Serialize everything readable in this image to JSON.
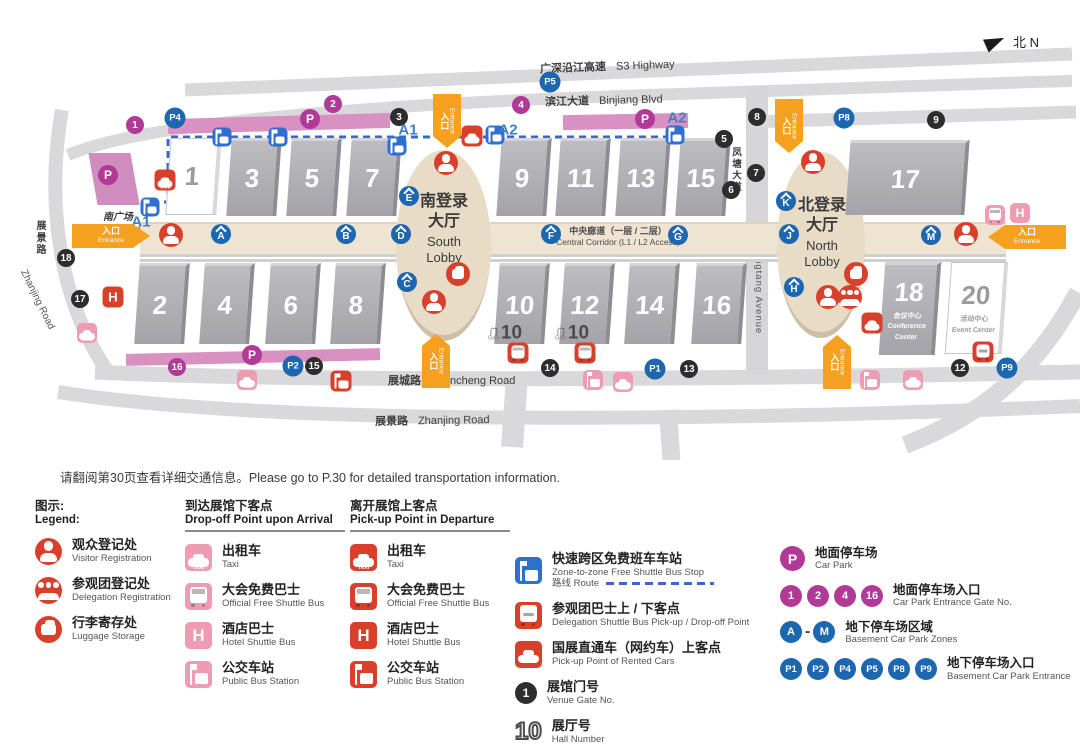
{
  "compass": {
    "label": "北 N"
  },
  "roads": {
    "s3": {
      "zh": "广深沿江高速",
      "en": "S3 Highway"
    },
    "binjiang": {
      "zh": "滨江大道",
      "en": "Binjiang Blvd"
    },
    "fengtang": {
      "zh": "凤塘大道",
      "en": "Fengtang Avenue"
    },
    "zhancheng": {
      "zh": "展城路",
      "en": "Zhancheng Road"
    },
    "zhanjing_bottom": {
      "zh": "展景路",
      "en": "Zhanjing Road"
    },
    "zhanjing_left": {
      "zh": "展景路",
      "en": "Zhanjing Road"
    }
  },
  "plaza": {
    "zh": "南广场",
    "en": "South Plaza"
  },
  "lobbies": {
    "south": {
      "zh1": "南登录",
      "zh2": "大厅",
      "en1": "South",
      "en2": "Lobby"
    },
    "north": {
      "zh1": "北登录",
      "zh2": "大厅",
      "en1": "North",
      "en2": "Lobby"
    }
  },
  "corridor": {
    "zh": "中央廊道（一层 / 二层）",
    "en": "Central Corridor (L1 / L2 Access)"
  },
  "entrance_label": {
    "zh": "入口",
    "en": "Entrance"
  },
  "halls": [
    {
      "x": 168,
      "y": 138,
      "w": 46,
      "h": 75,
      "n": "1",
      "white": true
    },
    {
      "x": 229,
      "y": 138,
      "w": 46,
      "h": 75,
      "n": "3"
    },
    {
      "x": 289,
      "y": 138,
      "w": 46,
      "h": 75,
      "n": "5"
    },
    {
      "x": 349,
      "y": 138,
      "w": 46,
      "h": 75,
      "n": "7"
    },
    {
      "x": 499,
      "y": 138,
      "w": 46,
      "h": 75,
      "n": "9"
    },
    {
      "x": 558,
      "y": 138,
      "w": 46,
      "h": 75,
      "n": "11"
    },
    {
      "x": 618,
      "y": 138,
      "w": 46,
      "h": 75,
      "n": "13"
    },
    {
      "x": 678,
      "y": 138,
      "w": 46,
      "h": 75,
      "n": "15"
    },
    {
      "x": 848,
      "y": 140,
      "w": 115,
      "h": 72,
      "n": "17"
    },
    {
      "x": 137,
      "y": 263,
      "w": 46,
      "h": 78,
      "n": "2"
    },
    {
      "x": 202,
      "y": 263,
      "w": 46,
      "h": 78,
      "n": "4"
    },
    {
      "x": 268,
      "y": 263,
      "w": 46,
      "h": 78,
      "n": "6"
    },
    {
      "x": 333,
      "y": 263,
      "w": 46,
      "h": 78,
      "n": "8"
    },
    {
      "x": 497,
      "y": 263,
      "w": 46,
      "h": 78,
      "n": "10"
    },
    {
      "x": 562,
      "y": 263,
      "w": 46,
      "h": 78,
      "n": "12"
    },
    {
      "x": 627,
      "y": 263,
      "w": 46,
      "h": 78,
      "n": "14"
    },
    {
      "x": 694,
      "y": 263,
      "w": 46,
      "h": 78,
      "n": "16"
    },
    {
      "x": 882,
      "y": 262,
      "w": 52,
      "h": 90,
      "n": "18",
      "sub_zh": "会议中心",
      "sub_en": "Conference Center"
    },
    {
      "x": 948,
      "y": 262,
      "w": 52,
      "h": 90,
      "n": "20",
      "white": true,
      "sub_zh": "活动中心",
      "sub_en": "Event Center"
    }
  ],
  "markers": {
    "venue_gates": [
      [
        399,
        117,
        "3"
      ],
      [
        724,
        139,
        "5"
      ],
      [
        731,
        190,
        "6"
      ],
      [
        756,
        173,
        "7"
      ],
      [
        757,
        117,
        "8"
      ],
      [
        936,
        120,
        "9"
      ],
      [
        960,
        368,
        "12"
      ],
      [
        689,
        369,
        "13"
      ],
      [
        550,
        368,
        "14"
      ],
      [
        314,
        366,
        "15"
      ],
      [
        80,
        299,
        "17"
      ],
      [
        66,
        258,
        "18"
      ]
    ],
    "carpark_gates": [
      [
        135,
        125,
        "1"
      ],
      [
        333,
        104,
        "2"
      ],
      [
        521,
        105,
        "4"
      ],
      [
        177,
        367,
        "16"
      ]
    ],
    "carpark_p": [
      [
        108,
        175
      ],
      [
        310,
        119
      ],
      [
        645,
        119
      ],
      [
        252,
        355
      ]
    ],
    "basement_entrances": [
      [
        655,
        369,
        "P1"
      ],
      [
        293,
        366,
        "P2"
      ],
      [
        175,
        118,
        "P4"
      ],
      [
        550,
        82,
        "P5"
      ],
      [
        844,
        118,
        "P8"
      ],
      [
        1007,
        368,
        "P9"
      ]
    ],
    "zones": [
      [
        221,
        234,
        "A"
      ],
      [
        346,
        234,
        "B"
      ],
      [
        407,
        282,
        "C"
      ],
      [
        401,
        234,
        "D"
      ],
      [
        409,
        196,
        "E"
      ],
      [
        551,
        234,
        "F"
      ],
      [
        678,
        235,
        "G"
      ],
      [
        794,
        287,
        "H"
      ],
      [
        789,
        234,
        "J"
      ],
      [
        786,
        201,
        "K"
      ],
      [
        931,
        235,
        "M"
      ]
    ],
    "red": {
      "visitor": [
        [
          171,
          235
        ],
        [
          446,
          163
        ],
        [
          434,
          302
        ],
        [
          813,
          162
        ],
        [
          966,
          234
        ],
        [
          828,
          297
        ]
      ],
      "delegation": [
        [
          850,
          297
        ]
      ],
      "luggage": [
        [
          458,
          274
        ],
        [
          856,
          274
        ]
      ],
      "taxi": [
        [
          165,
          180
        ]
      ],
      "car": [
        [
          472,
          136
        ],
        [
          872,
          323
        ]
      ],
      "bus": [
        [
          518,
          353
        ],
        [
          585,
          353
        ]
      ],
      "hotel": [
        [
          113,
          297
        ]
      ],
      "station": [
        [
          341,
          381
        ]
      ],
      "delegation_bus": [
        [
          983,
          352
        ]
      ]
    },
    "pink": {
      "taxi": [
        [
          87,
          333
        ],
        [
          247,
          380
        ],
        [
          623,
          382
        ],
        [
          913,
          380
        ]
      ],
      "bus": [
        [
          995,
          215
        ]
      ],
      "hotel": [
        [
          1020,
          213
        ]
      ],
      "station": [
        [
          593,
          380
        ],
        [
          870,
          380
        ]
      ]
    },
    "zone_stops": [
      [
        150,
        207
      ],
      [
        222,
        137
      ],
      [
        278,
        137
      ],
      [
        397,
        146
      ],
      [
        495,
        135
      ],
      [
        675,
        135
      ]
    ],
    "stop_names": [
      [
        141,
        222,
        "A1"
      ],
      [
        408,
        130,
        "A1"
      ],
      [
        508,
        130,
        "A2"
      ],
      [
        677,
        118,
        "A2"
      ]
    ],
    "gate10": {
      "positions": [
        [
          505,
          333
        ],
        [
          572,
          333
        ]
      ],
      "zh": "门",
      "en": "Gate",
      "num": "10"
    }
  },
  "entrances": [
    {
      "x": 72,
      "y": 224,
      "dir": "right"
    },
    {
      "x": 988,
      "y": 225,
      "dir": "left"
    },
    {
      "x": 433,
      "y": 94,
      "dir": "down"
    },
    {
      "x": 422,
      "y": 334,
      "dir": "up"
    },
    {
      "x": 775,
      "y": 99,
      "dir": "down"
    },
    {
      "x": 823,
      "y": 335,
      "dir": "up"
    }
  ],
  "legend": {
    "intro": "请翻阅第30页查看详细交通信息。Please go to P.30 for detailed transportation information.",
    "title_zh": "图示:",
    "title_en": "Legend:",
    "col1": [
      {
        "icon": "visitor",
        "color": "red",
        "shape": "circle",
        "zh": "观众登记处",
        "en": "Visitor Registration"
      },
      {
        "icon": "delegation",
        "color": "red",
        "shape": "circle",
        "zh": "参观团登记处",
        "en": "Delegation Registration"
      },
      {
        "icon": "luggage",
        "color": "red",
        "shape": "circle",
        "zh": "行李寄存处",
        "en": "Luggage Storage"
      }
    ],
    "col2": {
      "header_zh": "到达展馆下客点",
      "header_en": "Drop-off Point upon Arrival",
      "items": [
        {
          "icon": "taxi",
          "color": "pink",
          "shape": "sq",
          "zh": "出租车",
          "en": "Taxi"
        },
        {
          "icon": "bus",
          "color": "pink",
          "shape": "sq",
          "zh": "大会免费巴士",
          "en": "Official Free Shuttle Bus"
        },
        {
          "icon": "hotel",
          "color": "pink",
          "shape": "sq",
          "zh": "酒店巴士",
          "en": "Hotel Shuttle Bus"
        },
        {
          "icon": "station",
          "color": "pink",
          "shape": "sq",
          "zh": "公交车站",
          "en": "Public Bus Station"
        }
      ]
    },
    "col3": {
      "header_zh": "离开展馆上客点",
      "header_en": "Pick-up Point in Departure",
      "items": [
        {
          "icon": "taxi",
          "color": "red",
          "shape": "sq",
          "zh": "出租车",
          "en": "Taxi"
        },
        {
          "icon": "bus",
          "color": "red",
          "shape": "sq",
          "zh": "大会免费巴士",
          "en": "Official Free Shuttle Bus"
        },
        {
          "icon": "hotel",
          "color": "red",
          "shape": "sq",
          "zh": "酒店巴士",
          "en": "Hotel Shuttle Bus"
        },
        {
          "icon": "station",
          "color": "red",
          "shape": "sq",
          "zh": "公交车站",
          "en": "Public Bus Station"
        }
      ]
    },
    "col4": [
      {
        "icon": "zonestop",
        "color": "blue",
        "shape": "sq",
        "zh": "快速跨区免费班车车站",
        "en": "Zone-to-zone Free Shuttle Bus Stop",
        "route_zh": "路线",
        "route_en": "Route"
      },
      {
        "icon": "delegation_bus",
        "color": "red",
        "shape": "sq",
        "zh": "参观团巴士上 / 下客点",
        "en": "Delegation Shuttle Bus Pick-up / Drop-off Point"
      },
      {
        "icon": "car",
        "color": "red",
        "shape": "sq",
        "zh": "国展直通车（网约车）上客点",
        "en": "Pick-up Point of Rented Cars"
      },
      {
        "icon": "gate_badge",
        "badge": "1",
        "zh": "展馆门号",
        "en": "Venue Gate No."
      },
      {
        "icon": "hall_number",
        "badge": "10",
        "zh": "展厅号",
        "en": "Hall Number"
      }
    ],
    "col5": {
      "car_park": {
        "badge": "P",
        "zh": "地面停车场",
        "en": "Car Park"
      },
      "car_park_gates": {
        "badges": [
          "1",
          "2",
          "4",
          "16"
        ],
        "zh": "地面停车场入口",
        "en": "Car Park Entrance Gate No."
      },
      "basement_zones": {
        "badges": [
          "A",
          "M"
        ],
        "sep": "-",
        "zh": "地下停车场区域",
        "en": "Basement Car Park Zones"
      },
      "basement_entrances": {
        "badges": [
          "P1",
          "P2",
          "P4",
          "P5",
          "P8",
          "P9"
        ],
        "zh": "地下停车场入口",
        "en": "Basement Car Park Entrance"
      }
    }
  },
  "colors": {
    "red": "#d9402c",
    "pink": "#ef9cb3",
    "magenta": "#b03a96",
    "blue": "#1d66b0",
    "zone_blue": "#2e6fd0",
    "route_blue": "#3b66cc",
    "orange": "#f5a01e",
    "black_badge": "#2d2d2d",
    "road_gray": "#d9d9db",
    "hall_gray": "#a8a8ae",
    "corridor_beige": "#efe3d2",
    "lobby_beige": "#e9dcc7",
    "strip_pink": "#d891c1"
  }
}
